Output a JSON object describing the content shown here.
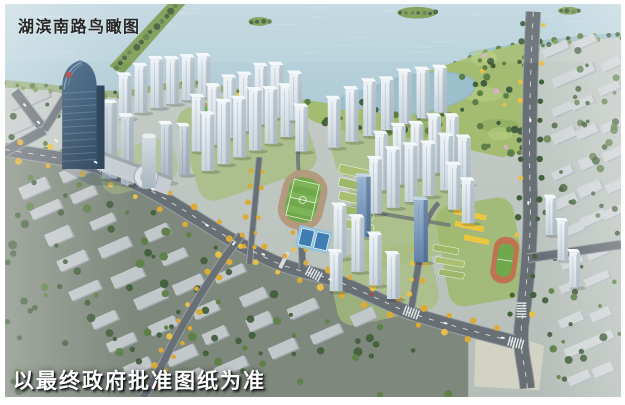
{
  "captions": {
    "title": "湖滨南路鸟瞰图",
    "disclaimer": "以最终政府批准图纸为准"
  },
  "palette": {
    "water": "#aecbd6",
    "waterLight": "#c2d8e0",
    "waterDeep": "#9cbfcc",
    "shoreGreen": "#7d9c55",
    "parkGreen": "#a3bc72",
    "parkLight": "#bcd084",
    "parkDark": "#8aa75c",
    "treeDark": "#42603c",
    "treeMid": "#5d7f47",
    "treePink": "#d6aec6",
    "treeYellow": "#dcab36",
    "treeYellow2": "#e7c04a",
    "pitchGreen": "#6fa94c",
    "pitchLight": "#7fb75a",
    "trackTan": "#b39a7f",
    "trackOrange": "#bf7350",
    "courtBlue": "#3f7db2",
    "courtLight": "#93c4da",
    "roadGray": "#686f75",
    "roadEdge": "#99a0a5",
    "laneWhite": "#e9ecee",
    "towerShade": "#8fa0ac",
    "towerTop": "#f4f8fa",
    "blueSide": "#41628a",
    "blueTop": "#c3d6e8",
    "cityBlock": "#c2c7ca",
    "cityShade": "#9fa6ab",
    "cityBlockE": "#d0d5d8",
    "cityShadeE": "#b2b9bf",
    "groundSW": "#7e887c",
    "groundBase": "#c0c7c4",
    "lawn": "#a7bd7e",
    "schoolYellow": "#e9c83e",
    "greenRoof": "#9cb868",
    "plaza": "#d2d2c5",
    "carRed": "#c03a30",
    "carWhite": "#f2f4f5",
    "landmarkDark": "#203a52",
    "crownLine": "#7fa3c0"
  }
}
